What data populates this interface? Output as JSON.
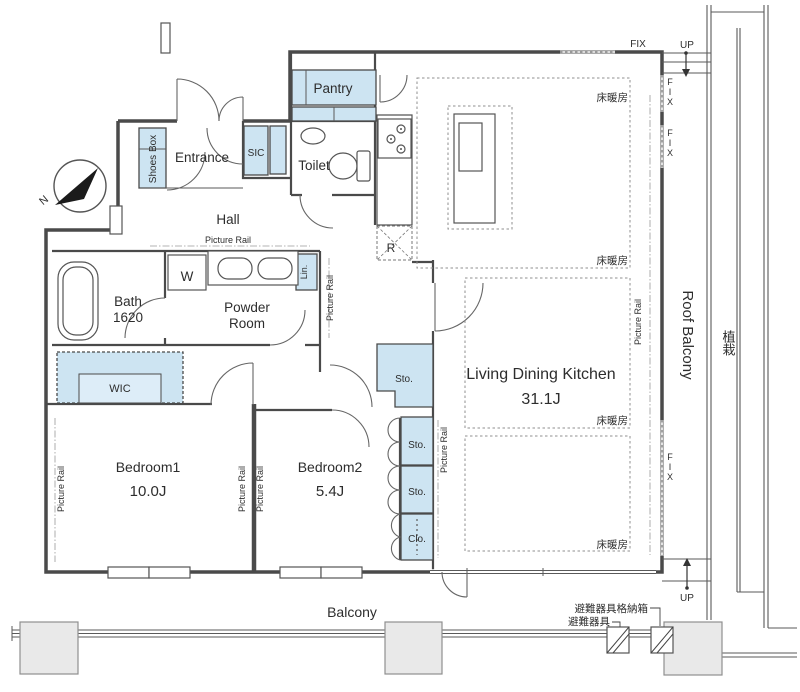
{
  "labels": {
    "north": "N",
    "entrance": "Entrance",
    "shoes_box": "Shoes Box",
    "sic": "SIC",
    "toilet": "Toilet",
    "pantry": "Pantry",
    "hall": "Hall",
    "washer": "W",
    "powder_line1": "Powder",
    "powder_line2": "Room",
    "linen": "Lin.",
    "bath": "Bath",
    "bath_size": "1620",
    "wic": "WIC",
    "bedroom1": "Bedroom1",
    "bedroom1_size": "10.0J",
    "bedroom2": "Bedroom2",
    "bedroom2_size": "5.4J",
    "ldk": "Living Dining Kitchen",
    "ldk_size": "31.1J",
    "storage": "Sto.",
    "closet": "Clo.",
    "fridge": "R",
    "balcony": "Balcony",
    "roof_balcony": "Roof Balcony",
    "planting": "植栽",
    "floor_heating": "床暖房",
    "picture_rail": "Picture Rail",
    "fix": "FIX",
    "up": "UP",
    "evac_storage_box": "避難器具格納箱",
    "evac_equipment": "避難器具"
  },
  "colors": {
    "storage_fill": "#cde4f2",
    "wall": "#4a4a4a",
    "pillar_fill": "#e9e9e9",
    "background": "#ffffff"
  }
}
